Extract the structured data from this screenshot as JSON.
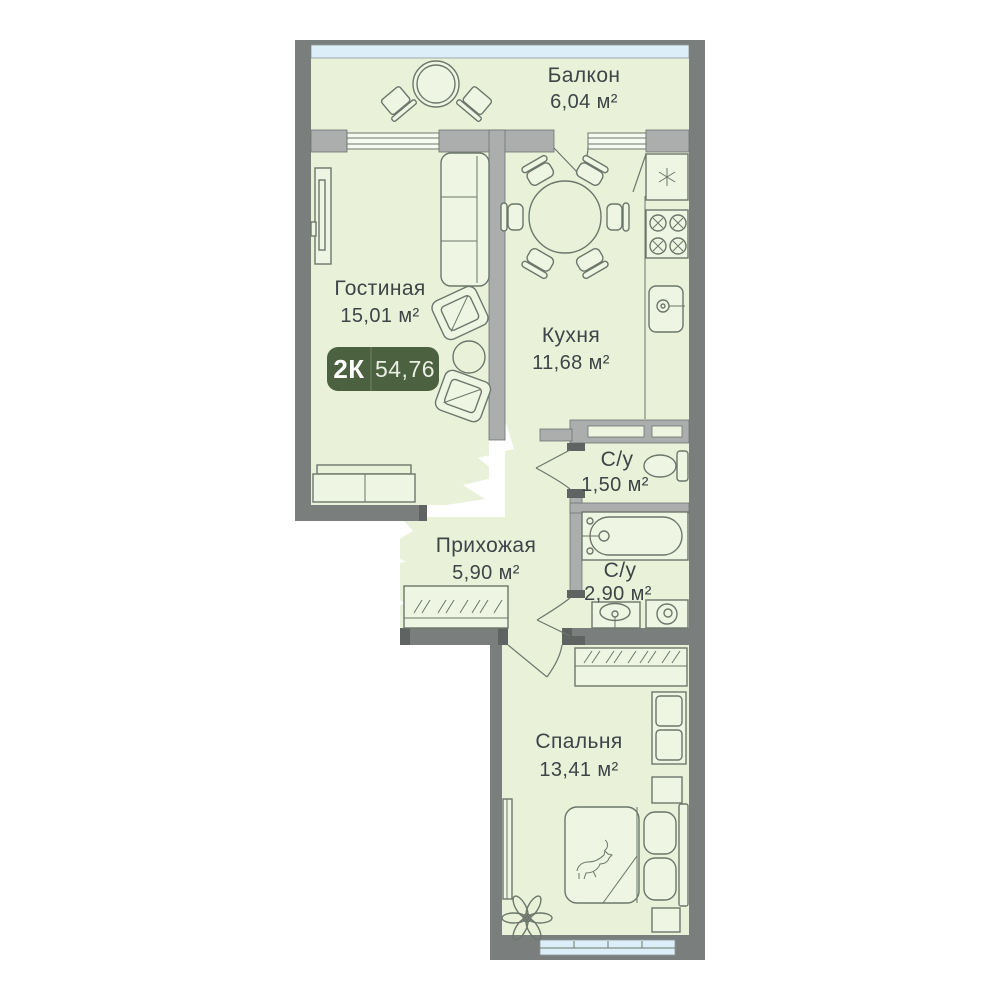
{
  "plan": {
    "type": "apartment-floor-plan",
    "badge": {
      "rooms_label": "2К",
      "total_area": "54,76"
    },
    "rooms": [
      {
        "name": "Балкон",
        "area": "6,04 м²"
      },
      {
        "name": "Гостиная",
        "area": "15,01 м²"
      },
      {
        "name": "Кухня",
        "area": "11,68 м²"
      },
      {
        "name": "С/у",
        "area": "1,50 м²"
      },
      {
        "name": "Прихожая",
        "area": "5,90 м²"
      },
      {
        "name": "С/у",
        "area": "2,90 м²"
      },
      {
        "name": "Спальня",
        "area": "13,41 м²"
      }
    ],
    "colors": {
      "floor": "#e9f2d9",
      "wall": "#7a7e7d",
      "partition": "#abaeac",
      "window_glass": "#dceef8",
      "badge": "#4c6140",
      "text": "#3e4448",
      "furniture_line": "#6c766b"
    },
    "furniture": {
      "balcony": [
        "round-table",
        "chair",
        "chair"
      ],
      "living": [
        "wall-tv",
        "sofa",
        "armchair",
        "coffee-table",
        "armchair",
        "dresser"
      ],
      "kitchen": [
        "fridge",
        "stove",
        "sink",
        "dining-table",
        "six-chairs"
      ],
      "wc_small": [
        "toilet"
      ],
      "hallway": [
        "wardrobe"
      ],
      "wc_big": [
        "bathtub",
        "sink",
        "washing-machine"
      ],
      "bedroom": [
        "wardrobe",
        "cabinet",
        "nightstand",
        "double-bed",
        "cat",
        "nightstand",
        "plant",
        "mirror"
      ]
    }
  }
}
